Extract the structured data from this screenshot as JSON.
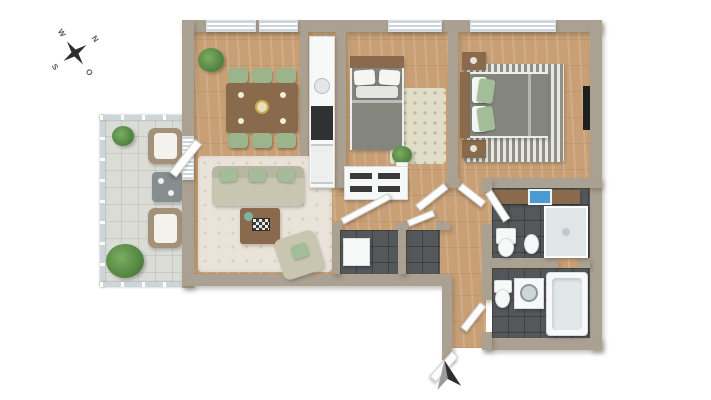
{
  "title": "3d-apartment-floor-plan",
  "compass": {
    "north": "N",
    "east": "O",
    "south": "S",
    "west": "W"
  },
  "entrance": {
    "marker": "north-entrance-arrow"
  },
  "colors": {
    "wall": "#aba192",
    "wood": "#c9a076",
    "tile_dark": "#54585b",
    "balcony_tile": "#dbdcd6",
    "glass": "#ccd6da",
    "cream_rug": "#e9e3d9",
    "rug_b1": "#e2ddc9",
    "sofa": "#c8c5b1",
    "green_pillow": "#a3bd98",
    "chair_green": "#9cb48c",
    "table_brown": "#8a6a4c",
    "duvet_gray": "#84867e",
    "fixture": "#f7f9f9",
    "appliance": "#2f3233",
    "blue": "#4a9bd4",
    "plant": "#4e8040",
    "plant_light": "#7cad60",
    "rattan": "#a3917a",
    "arrow_dark": "#2e2e2e",
    "arrow_gray": "#9c9c9c"
  },
  "rooms": [
    {
      "id": "living-dining-room",
      "floor": "wood",
      "furniture": [
        "potted-plant",
        "dining-table",
        "dining-chairs-x6",
        "area-rug",
        "sofa",
        "green-throw-pillows",
        "coffee-table",
        "game-board",
        "armchair"
      ]
    },
    {
      "id": "kitchen-niche",
      "floor": "wood",
      "furniture": [
        "tall-cabinet",
        "sink",
        "cooktop",
        "oven"
      ]
    },
    {
      "id": "bedroom-1",
      "floor": "wood",
      "furniture": [
        "bed",
        "white-pillows",
        "dotted-rug",
        "potted-plant"
      ]
    },
    {
      "id": "bedroom-2",
      "floor": "wood",
      "furniture": [
        "double-bed",
        "green-pillows",
        "nightstand-top",
        "nightstand-bottom",
        "striped-rug",
        "wall-tv"
      ]
    },
    {
      "id": "hallway",
      "floor": "wood",
      "furniture": [
        "sideboard",
        "open-doors"
      ]
    },
    {
      "id": "storage-closet",
      "floor": "dark-tile",
      "furniture": [
        "washer-box",
        "shelf-bay"
      ]
    },
    {
      "id": "bathroom-upper",
      "floor": "dark-tile",
      "furniture": [
        "vanity-counter",
        "blue-washbasin",
        "shower",
        "toilet",
        "bidet"
      ]
    },
    {
      "id": "bathroom-lower",
      "floor": "dark-tile",
      "furniture": [
        "toilet",
        "washing-machine",
        "bathtub"
      ]
    },
    {
      "id": "balcony",
      "floor": "balcony-tile",
      "furniture": [
        "glass-railing",
        "lounge-chair-1",
        "lounge-chair-2",
        "side-table",
        "potted-plant-small",
        "potted-plant-large"
      ]
    }
  ]
}
